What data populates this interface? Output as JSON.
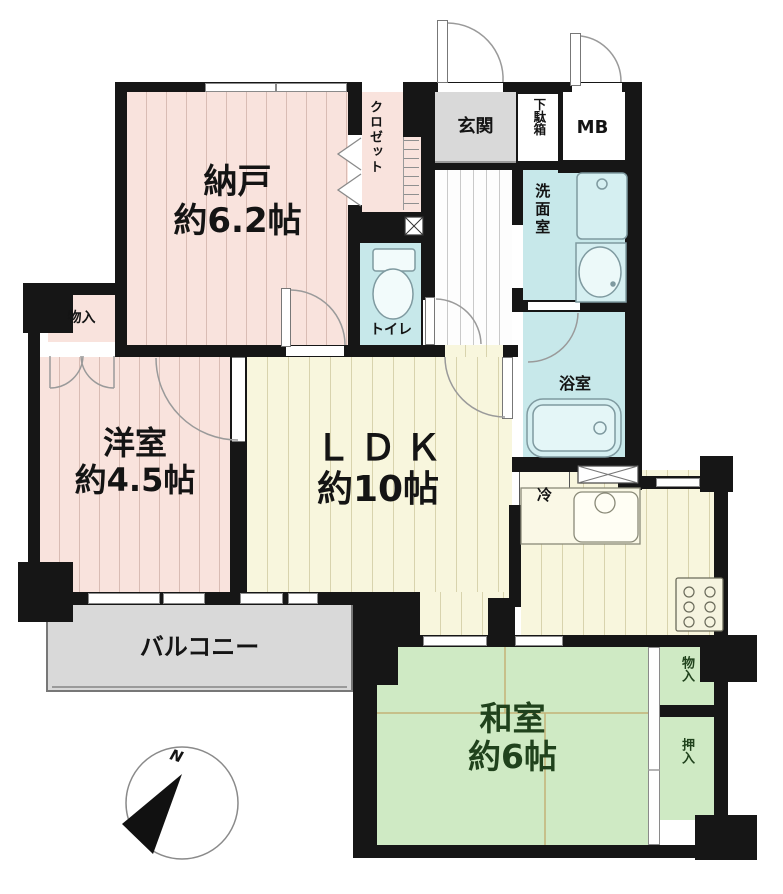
{
  "plan_title": "apartment floor plan",
  "rooms": {
    "nando": {
      "name": "納戸",
      "size": "約6.2帖"
    },
    "closet": {
      "name": "クロゼット"
    },
    "genkan": {
      "name": "玄関"
    },
    "getabako": {
      "name": "下駄箱"
    },
    "mb": {
      "name": "MB"
    },
    "senmen": {
      "name": "洗面室"
    },
    "toilet": {
      "name": "トイレ"
    },
    "bath": {
      "name": "浴室"
    },
    "yoshitsu": {
      "name": "洋室",
      "size": "約4.5帖"
    },
    "monoire_west": {
      "name": "物入"
    },
    "ldk": {
      "name": "ＬＤＫ",
      "size": "約10帖"
    },
    "rei": {
      "name": "冷"
    },
    "balcony": {
      "name": "バルコニー"
    },
    "washitsu": {
      "name": "和室",
      "size": "約6帖"
    },
    "monoire_east": {
      "name": "物入"
    },
    "oshiire": {
      "name": "押入"
    }
  },
  "compass": {
    "north_label": "N"
  },
  "icons": {
    "compass": "north-compass-icon",
    "toilet": "toilet-fixture",
    "bathtub": "bathtub-fixture",
    "washing_machine": "washing-machine-fixture",
    "washbasin": "washbasin-fixture",
    "kitchen_sink": "kitchen-sink-fixture",
    "stove": "gas-stove-fixture"
  },
  "colors": {
    "wall": "#161616",
    "room_pink": "#f9e3dd",
    "room_cream": "#f8f6dd",
    "room_blue": "#c7e8ea",
    "room_green": "#cfeac4",
    "room_gray": "#d9d9d9",
    "washitsu_text": "#20421c"
  }
}
